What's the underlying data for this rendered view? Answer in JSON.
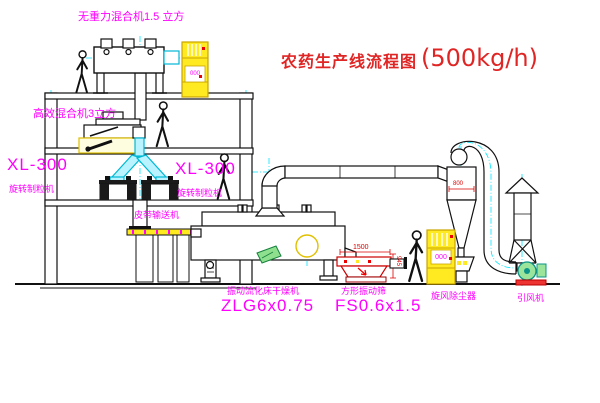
{
  "title": {
    "name": "农药生产线流程图",
    "capacity": "(500kg/h)"
  },
  "equipment_labels": {
    "gravity_mixer": "无重力混合机1.5 立方",
    "high_mixer": "高效混合机3立方",
    "granulator_model_left": "XL-300",
    "granulator_left": "旋转制粒机",
    "granulator_model_mid": "XL-300",
    "granulator_mid": "旋转制粒机",
    "belt_conveyor": "皮带输送机",
    "dryer": "振动流化床干燥机",
    "dryer_model": "ZLG6x0.75",
    "sieve": "方形振动筛",
    "sieve_model": "FS0.6x1.5",
    "cyclone": "旋风除尘器",
    "fan": "引风机"
  },
  "dimensions": {
    "cyclone_width": "800",
    "sieve_length": "1500",
    "sieve_height": "945"
  },
  "cabinet_text": {
    "elevator1": "000",
    "elevator2": "000"
  },
  "colors": {
    "label_magenta": "#ff00ff",
    "title_red": "#e02525",
    "dimension_red": "#dd0000",
    "machine_yellow": "#ffe920",
    "pipe_cyan": "#00b8d4",
    "centerline_cyan": "#00e5ff"
  }
}
